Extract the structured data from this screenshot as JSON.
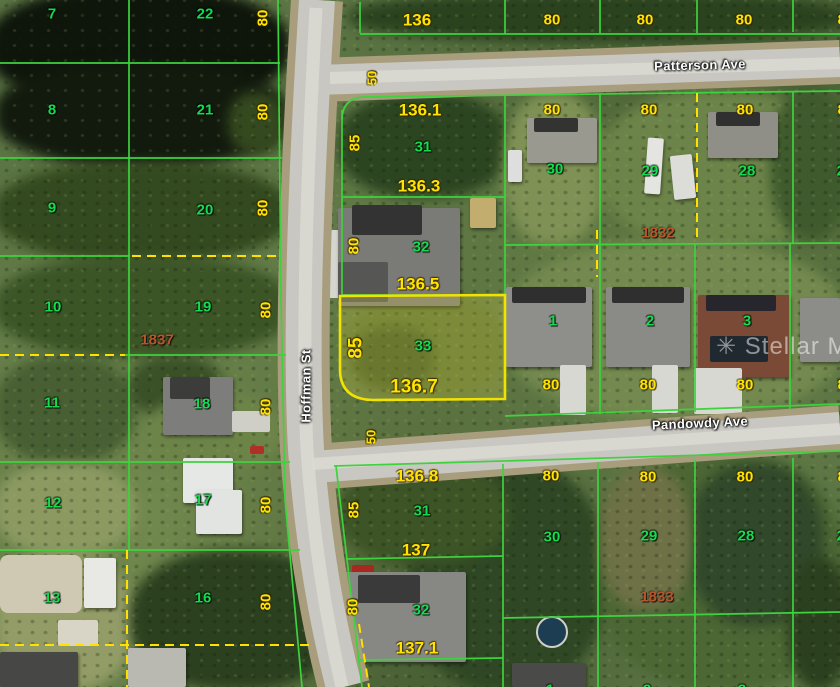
{
  "map": {
    "type": "aerial-plat-map",
    "watermark": "Stellar MLS",
    "streets": [
      "Patterson Ave",
      "Pandowdy Ave",
      "Hoffman St"
    ],
    "highlighted_parcel": {
      "lot_number": "33",
      "visible_dimensions": [
        "136.5",
        "136.7",
        "85"
      ],
      "outline_color": "#f2e200"
    },
    "plat_references": [
      "1837",
      "1832",
      "1833"
    ],
    "colors": {
      "lot_line_green": "#3ed23e",
      "lot_number_green": "#12dd4e",
      "dimension_yellow": "#ffe400",
      "plat_ref_red": "#b8552c",
      "road_gray": "#c8c7c1",
      "pond_dark": "#10180c"
    },
    "labels": [
      {
        "t": "7",
        "c": "lot",
        "x": 52,
        "y": 14
      },
      {
        "t": "22",
        "c": "lot",
        "x": 205,
        "y": 14
      },
      {
        "t": "8",
        "c": "lot",
        "x": 52,
        "y": 110
      },
      {
        "t": "21",
        "c": "lot",
        "x": 205,
        "y": 110
      },
      {
        "t": "9",
        "c": "lot",
        "x": 52,
        "y": 208
      },
      {
        "t": "20",
        "c": "lot",
        "x": 205,
        "y": 210
      },
      {
        "t": "10",
        "c": "lot",
        "x": 53,
        "y": 307
      },
      {
        "t": "19",
        "c": "lot",
        "x": 203,
        "y": 307
      },
      {
        "t": "11",
        "c": "lot",
        "x": 52,
        "y": 403
      },
      {
        "t": "18",
        "c": "lot",
        "x": 202,
        "y": 404
      },
      {
        "t": "12",
        "c": "lot",
        "x": 53,
        "y": 503
      },
      {
        "t": "17",
        "c": "lot",
        "x": 203,
        "y": 500
      },
      {
        "t": "13",
        "c": "lot",
        "x": 52,
        "y": 598
      },
      {
        "t": "16",
        "c": "lot",
        "x": 203,
        "y": 598
      },
      {
        "t": "31",
        "c": "lot",
        "x": 423,
        "y": 147
      },
      {
        "t": "30",
        "c": "lot",
        "x": 555,
        "y": 169
      },
      {
        "t": "29",
        "c": "lot",
        "x": 650,
        "y": 171
      },
      {
        "t": "28",
        "c": "lot",
        "x": 747,
        "y": 171
      },
      {
        "t": "27",
        "c": "lot",
        "x": 845,
        "y": 171
      },
      {
        "t": "32",
        "c": "lot",
        "x": 421,
        "y": 247
      },
      {
        "t": "33",
        "c": "lot",
        "x": 423,
        "y": 346
      },
      {
        "t": "1",
        "c": "lot",
        "x": 553,
        "y": 321
      },
      {
        "t": "2",
        "c": "lot",
        "x": 650,
        "y": 321
      },
      {
        "t": "3",
        "c": "lot",
        "x": 747,
        "y": 321
      },
      {
        "t": "31",
        "c": "lot",
        "x": 422,
        "y": 511
      },
      {
        "t": "30",
        "c": "lot",
        "x": 552,
        "y": 537
      },
      {
        "t": "29",
        "c": "lot",
        "x": 649,
        "y": 536
      },
      {
        "t": "28",
        "c": "lot",
        "x": 746,
        "y": 536
      },
      {
        "t": "27",
        "c": "lot",
        "x": 845,
        "y": 536
      },
      {
        "t": "32",
        "c": "lot",
        "x": 421,
        "y": 610
      },
      {
        "t": "1",
        "c": "lot",
        "x": 550,
        "y": 690
      },
      {
        "t": "2",
        "c": "lot",
        "x": 647,
        "y": 690
      },
      {
        "t": "3",
        "c": "lot",
        "x": 742,
        "y": 690
      },
      {
        "t": "80",
        "c": "dim",
        "x": 263,
        "y": 18,
        "r": -90
      },
      {
        "t": "80",
        "c": "dim",
        "x": 263,
        "y": 112,
        "r": -90
      },
      {
        "t": "80",
        "c": "dim",
        "x": 263,
        "y": 208,
        "r": -90
      },
      {
        "t": "80",
        "c": "dim",
        "x": 266,
        "y": 310,
        "r": -90
      },
      {
        "t": "80",
        "c": "dim",
        "x": 266,
        "y": 407,
        "r": -90
      },
      {
        "t": "80",
        "c": "dim",
        "x": 266,
        "y": 505,
        "r": -90
      },
      {
        "t": "80",
        "c": "dim",
        "x": 266,
        "y": 602,
        "r": -90
      },
      {
        "t": "50",
        "c": "dim",
        "x": 372,
        "y": 78,
        "r": -90,
        "s": 13
      },
      {
        "t": "50",
        "c": "dim",
        "x": 371,
        "y": 437,
        "r": -90,
        "s": 13
      },
      {
        "t": "85",
        "c": "dim",
        "x": 355,
        "y": 143,
        "r": -90
      },
      {
        "t": "80",
        "c": "dim",
        "x": 354,
        "y": 246,
        "r": -90
      },
      {
        "t": "85",
        "c": "dim",
        "x": 356,
        "y": 348,
        "r": -90,
        "s": 19
      },
      {
        "t": "85",
        "c": "dim",
        "x": 354,
        "y": 510,
        "r": -90
      },
      {
        "t": "80",
        "c": "dim",
        "x": 353,
        "y": 607,
        "r": -90
      },
      {
        "t": "136",
        "c": "dim",
        "x": 417,
        "y": 20,
        "s": 17
      },
      {
        "t": "80",
        "c": "dim",
        "x": 552,
        "y": 20
      },
      {
        "t": "80",
        "c": "dim",
        "x": 645,
        "y": 20
      },
      {
        "t": "80",
        "c": "dim",
        "x": 744,
        "y": 20
      },
      {
        "t": "80",
        "c": "dim",
        "x": 846,
        "y": 20
      },
      {
        "t": "136.1",
        "c": "dim",
        "x": 420,
        "y": 110,
        "s": 17
      },
      {
        "t": "80",
        "c": "dim",
        "x": 552,
        "y": 110
      },
      {
        "t": "80",
        "c": "dim",
        "x": 649,
        "y": 110
      },
      {
        "t": "80",
        "c": "dim",
        "x": 745,
        "y": 110
      },
      {
        "t": "80",
        "c": "dim",
        "x": 846,
        "y": 110
      },
      {
        "t": "136.3",
        "c": "dim",
        "x": 419,
        "y": 186,
        "s": 17
      },
      {
        "t": "136.5",
        "c": "dim",
        "x": 418,
        "y": 284,
        "s": 17
      },
      {
        "t": "136.7",
        "c": "dim",
        "x": 414,
        "y": 387,
        "s": 19
      },
      {
        "t": "80",
        "c": "dim",
        "x": 551,
        "y": 385
      },
      {
        "t": "80",
        "c": "dim",
        "x": 648,
        "y": 385
      },
      {
        "t": "80",
        "c": "dim",
        "x": 745,
        "y": 385
      },
      {
        "t": "80",
        "c": "dim",
        "x": 846,
        "y": 385
      },
      {
        "t": "136.8",
        "c": "dim",
        "x": 417,
        "y": 476,
        "s": 17
      },
      {
        "t": "80",
        "c": "dim",
        "x": 551,
        "y": 476
      },
      {
        "t": "80",
        "c": "dim",
        "x": 648,
        "y": 477
      },
      {
        "t": "80",
        "c": "dim",
        "x": 745,
        "y": 477
      },
      {
        "t": "80",
        "c": "dim",
        "x": 846,
        "y": 477
      },
      {
        "t": "137",
        "c": "dim",
        "x": 416,
        "y": 550,
        "s": 17
      },
      {
        "t": "137.1",
        "c": "dim",
        "x": 417,
        "y": 648,
        "s": 17
      },
      {
        "t": "1837",
        "c": "plat",
        "x": 157,
        "y": 340
      },
      {
        "t": "1832",
        "c": "plat",
        "x": 658,
        "y": 233
      },
      {
        "t": "1833",
        "c": "plat",
        "x": 657,
        "y": 597
      },
      {
        "t": "Patterson Ave",
        "c": "street",
        "x": 700,
        "y": 65,
        "r": -1.5
      },
      {
        "t": "Pandowdy Ave",
        "c": "street",
        "x": 700,
        "y": 423,
        "r": -2.5
      },
      {
        "t": "Hoffman St",
        "c": "street",
        "x": 306,
        "y": 386,
        "r": -90
      },
      {
        "t": "✳ Stellar MLS",
        "c": "wm",
        "x": 716,
        "y": 347
      }
    ]
  }
}
